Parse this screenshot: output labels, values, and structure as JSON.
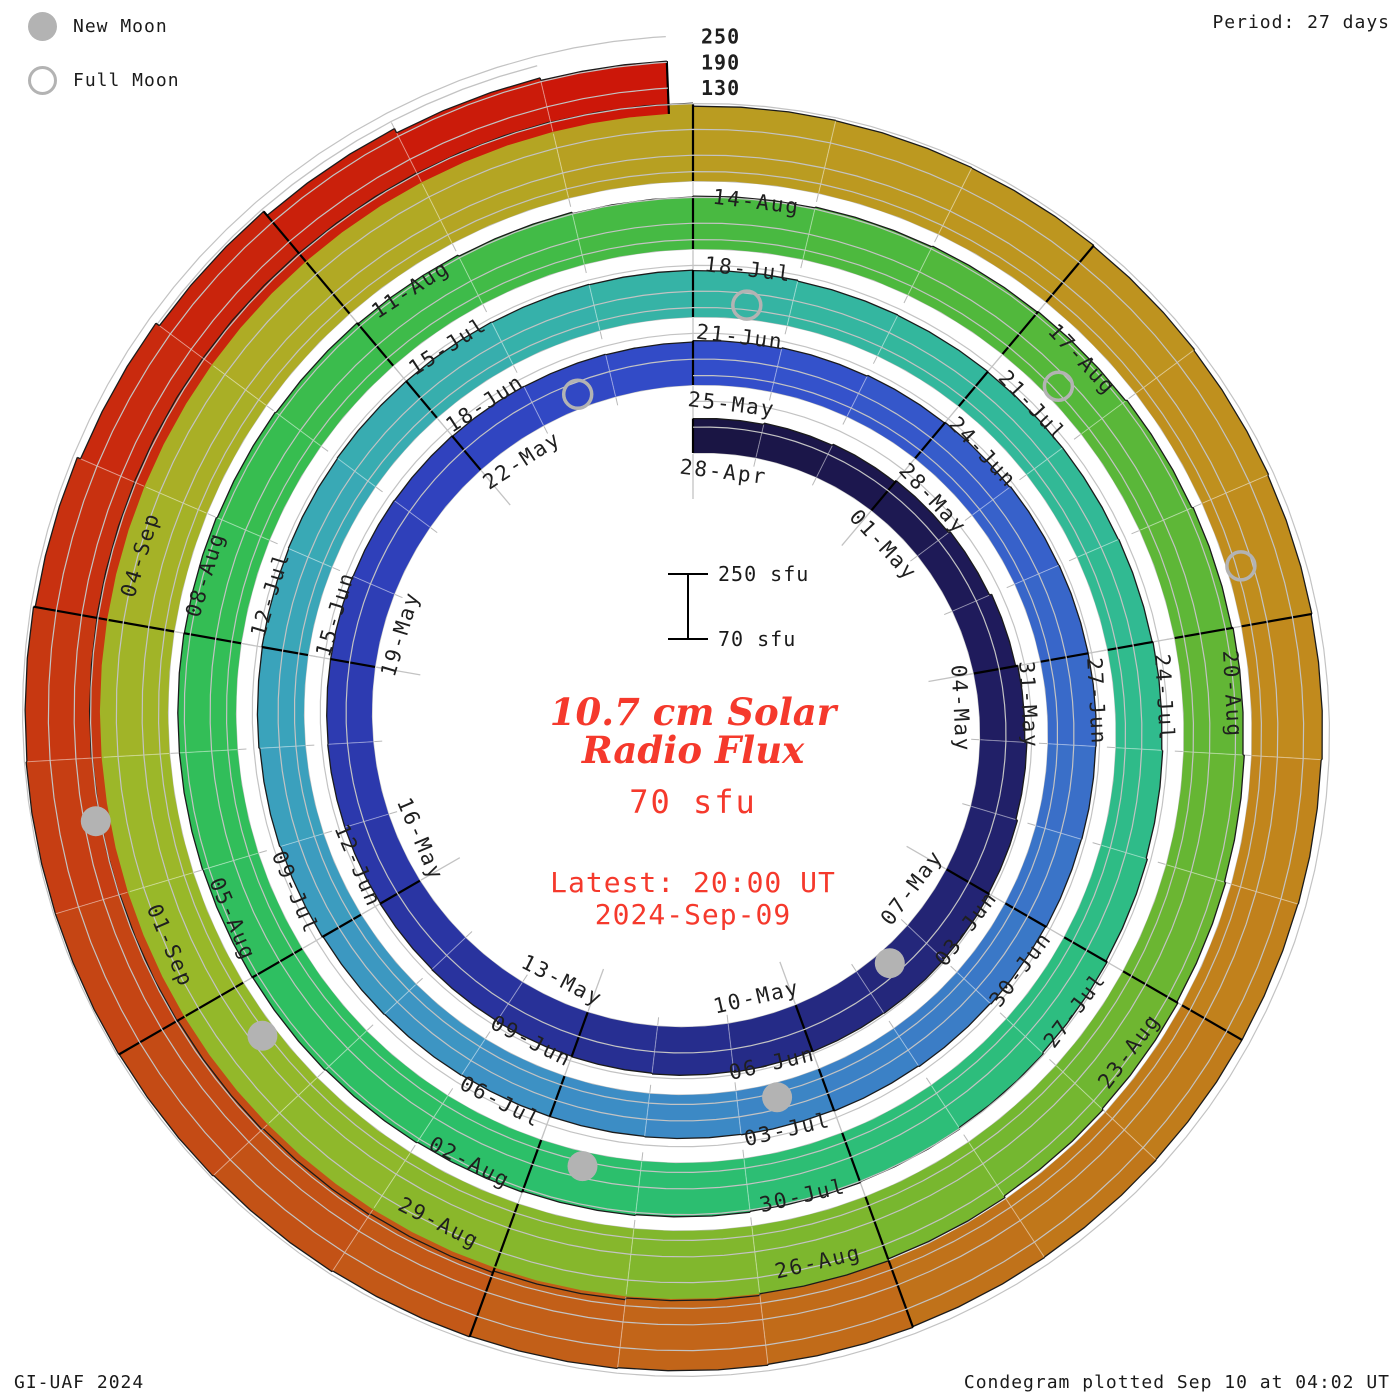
{
  "header": {
    "period": "Period: 27 days"
  },
  "legend": {
    "new_moon": "New Moon",
    "full_moon": "Full Moon"
  },
  "center": {
    "title_line1": "10.7 cm Solar",
    "title_line2": "Radio Flux",
    "flux_value": "70 sfu",
    "latest_line1": "Latest: 20:00 UT",
    "latest_line2": "2024-Sep-09"
  },
  "scale_bar": {
    "top_label": "250 sfu",
    "bottom_label": "70 sfu"
  },
  "footer": {
    "left": "GI-UAF 2024",
    "right": "Condegram plotted Sep 10 at 04:02 UT"
  },
  "colors": {
    "accent_red": "#f5392c",
    "moon_grey": "#b3b3b3",
    "grid_grey": "#c3c3c3",
    "tick_grey": "#b8b8b8",
    "label_black": "#1f1f1f",
    "edge_black": "#1b1b1b"
  },
  "chart_data": {
    "type": "bar",
    "subtype": "condegram-spiral",
    "title": "10.7 cm Solar Radio Flux",
    "period_days": 27,
    "start_date": "2024-04-28",
    "end_date_label": "2024-Sep-09",
    "latest_time": "20:00 UT",
    "revolutions": 5,
    "radial_scale": {
      "unit": "sfu",
      "baseline": 70,
      "gridlines": [
        130,
        190,
        250
      ]
    },
    "tick_labels": [
      "28-Apr",
      "01-May",
      "04-May",
      "07-May",
      "10-May",
      "13-May",
      "16-May",
      "19-May",
      "22-May",
      "25-May",
      "28-May",
      "31-May",
      "03-Jun",
      "06-Jun",
      "09-Jun",
      "12-Jun",
      "15-Jun",
      "18-Jun",
      "21-Jun",
      "24-Jun",
      "27-Jun",
      "30-Jun",
      "03-Jul",
      "06-Jul",
      "09-Jul",
      "12-Jul",
      "15-Jul",
      "18-Jul",
      "21-Jul",
      "24-Jul",
      "27-Jul",
      "30-Jul",
      "02-Aug",
      "05-Aug",
      "08-Aug",
      "11-Aug",
      "14-Aug",
      "17-Aug",
      "20-Aug",
      "23-Aug",
      "26-Aug",
      "29-Aug",
      "01-Sep",
      "04-Sep"
    ],
    "daily_flux_sfu": [
      150,
      153,
      156,
      160,
      164,
      169,
      174,
      179,
      183,
      185,
      186,
      185,
      184,
      182,
      180,
      179,
      178,
      177,
      176,
      176,
      175,
      175,
      174,
      173,
      172,
      171,
      170,
      173,
      175,
      177,
      179,
      181,
      182,
      182,
      181,
      180,
      178,
      176,
      174,
      172,
      171,
      170,
      170,
      171,
      172,
      174,
      176,
      178,
      179,
      180,
      181,
      181,
      180,
      179,
      178,
      176,
      175,
      174,
      174,
      175,
      177,
      179,
      182,
      185,
      188,
      191,
      193,
      195,
      197,
      199,
      201,
      203,
      204,
      205,
      205,
      204,
      202,
      200,
      197,
      194,
      191,
      193,
      195,
      197,
      199,
      202,
      205,
      208,
      211,
      214,
      217,
      220,
      224,
      228,
      232,
      236,
      240,
      243,
      246,
      248,
      250,
      252,
      253,
      254,
      254,
      253,
      252,
      251,
      244,
      243,
      242,
      240,
      238,
      236,
      234,
      232,
      231,
      231,
      232,
      233,
      235,
      237,
      239,
      241,
      243,
      245,
      246,
      246,
      244,
      240,
      232,
      222,
      210,
      199,
      193
    ],
    "end_day": 134.83,
    "moons": {
      "new": [
        {
          "label": "08-May",
          "day": 10.55
        },
        {
          "label": "06-Jun",
          "day": 39.55
        },
        {
          "label": "05-Jul",
          "day": 68.55
        },
        {
          "label": "04-Aug",
          "day": 98.55
        },
        {
          "label": "02-Sep",
          "day": 127.55
        }
      ],
      "full": [
        {
          "label": "23-May",
          "day": 25.55
        },
        {
          "label": "21-Jun",
          "day": 54.55
        },
        {
          "label": "21-Jul",
          "day": 84.55
        },
        {
          "label": "19-Aug",
          "day": 113.55
        }
      ]
    },
    "color_stops": [
      [
        0,
        "#1a1442"
      ],
      [
        6,
        "#1f1c5e"
      ],
      [
        12,
        "#252a84"
      ],
      [
        18,
        "#2a36a6"
      ],
      [
        24,
        "#3043c0"
      ],
      [
        28,
        "#3350cb"
      ],
      [
        33,
        "#3968c9"
      ],
      [
        38,
        "#3b7fc6"
      ],
      [
        43,
        "#3d93c4"
      ],
      [
        48,
        "#3aa5ba"
      ],
      [
        53,
        "#36b2a8"
      ],
      [
        58,
        "#32b998"
      ],
      [
        64,
        "#2dbd7e"
      ],
      [
        70,
        "#2cbf66"
      ],
      [
        76,
        "#35bd52"
      ],
      [
        82,
        "#4bb93f"
      ],
      [
        88,
        "#64b634"
      ],
      [
        94,
        "#7fb72d"
      ],
      [
        100,
        "#9ab829"
      ],
      [
        105,
        "#b0ab25"
      ],
      [
        109,
        "#bb9a20"
      ],
      [
        114,
        "#c18c1d"
      ],
      [
        119,
        "#c0751a"
      ],
      [
        124,
        "#c35517"
      ],
      [
        128,
        "#c63b12"
      ],
      [
        131,
        "#c9260d"
      ],
      [
        135,
        "#cc1508"
      ]
    ]
  }
}
